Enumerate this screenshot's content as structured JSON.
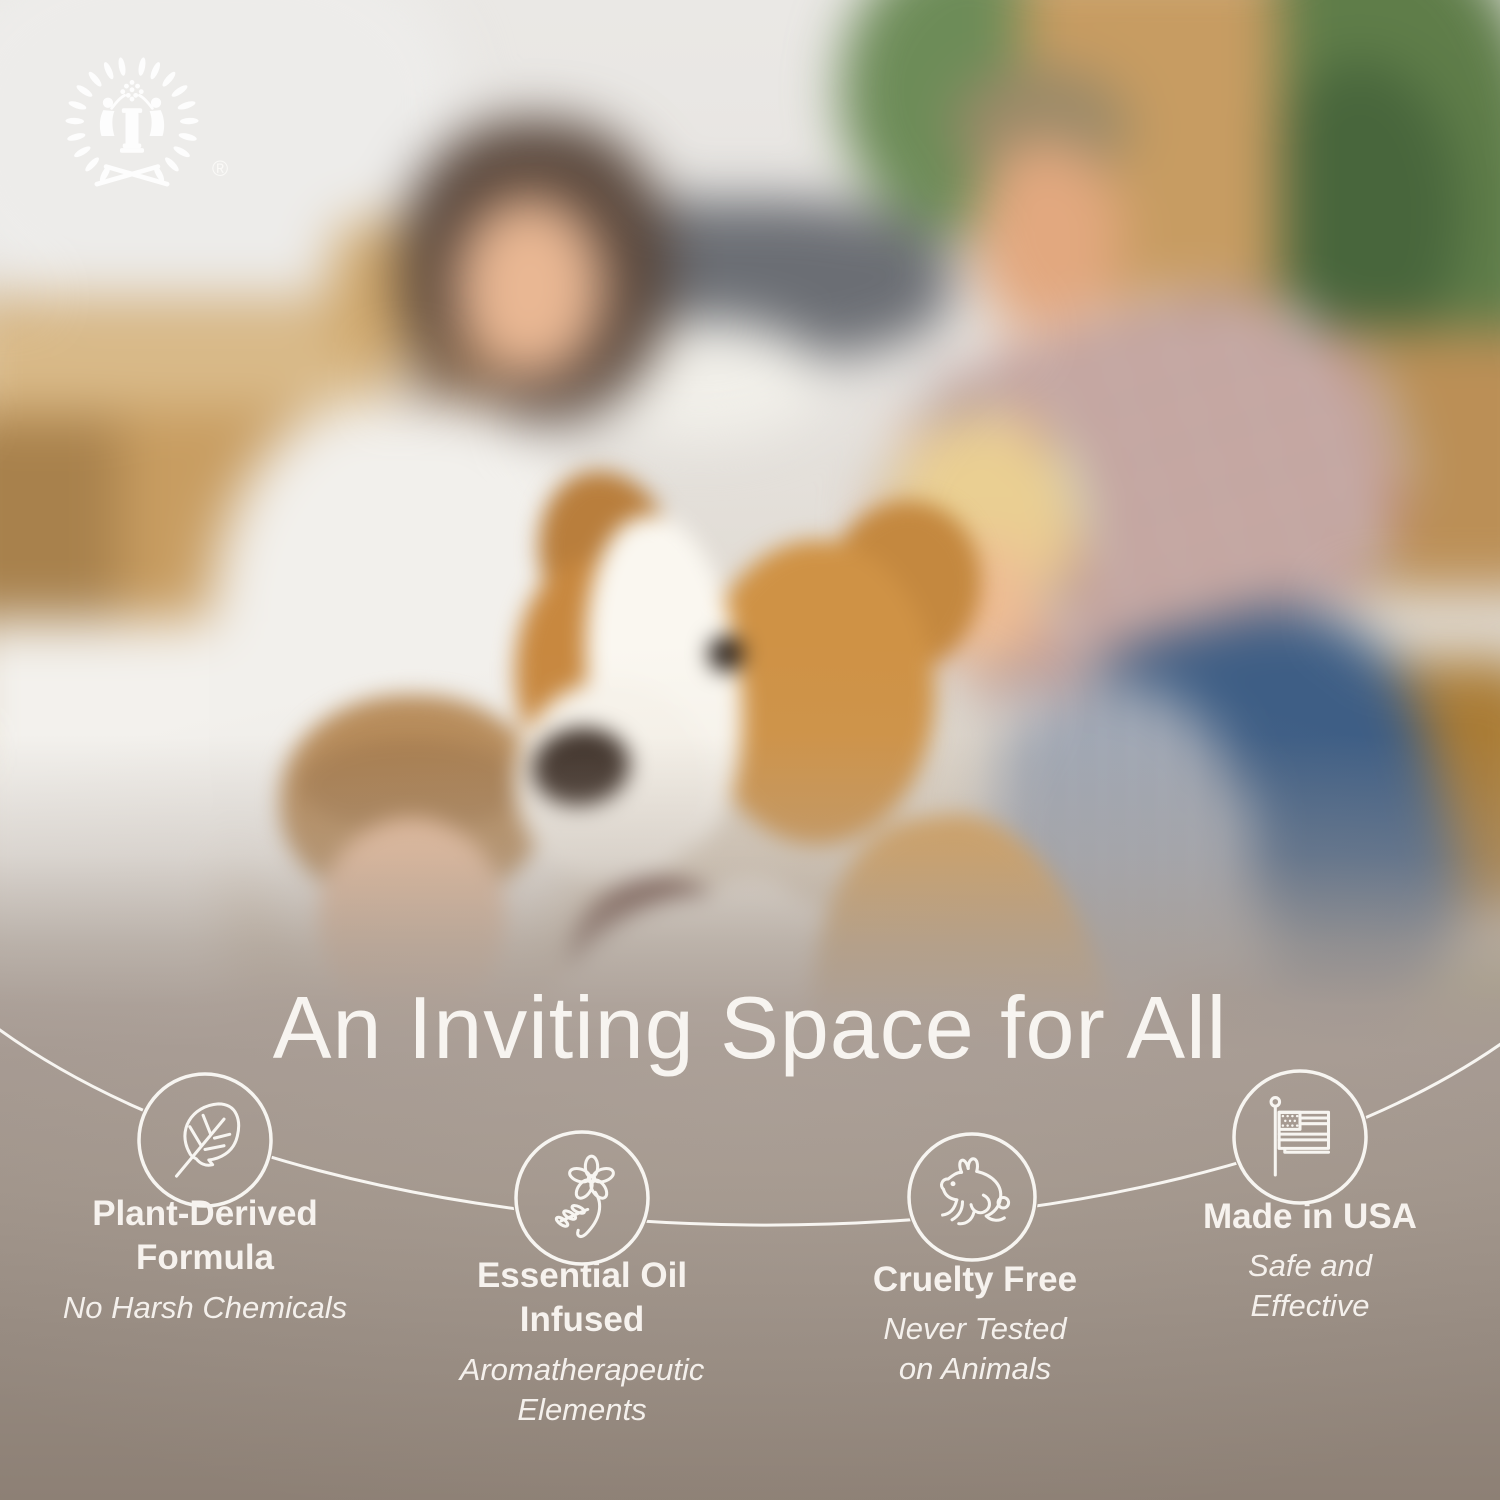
{
  "brand": {
    "logo_icon": "laurel-wreath-figures-logo",
    "registered_mark": "®"
  },
  "headline": "An Inviting Space for All",
  "features": [
    {
      "icon": "leaf-icon",
      "title": "Plant-Derived Formula",
      "title_lines": [
        "Plant-Derived",
        "Formula"
      ],
      "subtitle": "No Harsh Chemicals",
      "subtitle_lines": [
        "No Harsh Chemicals"
      ]
    },
    {
      "icon": "flower-icon",
      "title": "Essential Oil Infused",
      "title_lines": [
        "Essential Oil",
        "Infused"
      ],
      "subtitle": "Aromatherapeutic Elements",
      "subtitle_lines": [
        "Aromatherapeutic",
        "Elements"
      ]
    },
    {
      "icon": "rabbit-icon",
      "title": "Cruelty Free",
      "title_lines": [
        "Cruelty Free"
      ],
      "subtitle": "Never Tested on Animals",
      "subtitle_lines": [
        "Never Tested",
        "on Animals"
      ]
    },
    {
      "icon": "usa-flag-icon",
      "title": "Made in USA",
      "title_lines": [
        "Made in USA"
      ],
      "subtitle": "Safe and Effective",
      "subtitle_lines": [
        "Safe and",
        "Effective"
      ]
    }
  ],
  "scene": {
    "photo_subject": "Blurred family of four with dog among moving boxes",
    "colors": {
      "text": "#f6f2ee",
      "line": "#f7f5f1",
      "backdrop_taupe": "#8d8075",
      "dog_tan": "#d29a52",
      "plant_green": "#5f7d49"
    }
  }
}
